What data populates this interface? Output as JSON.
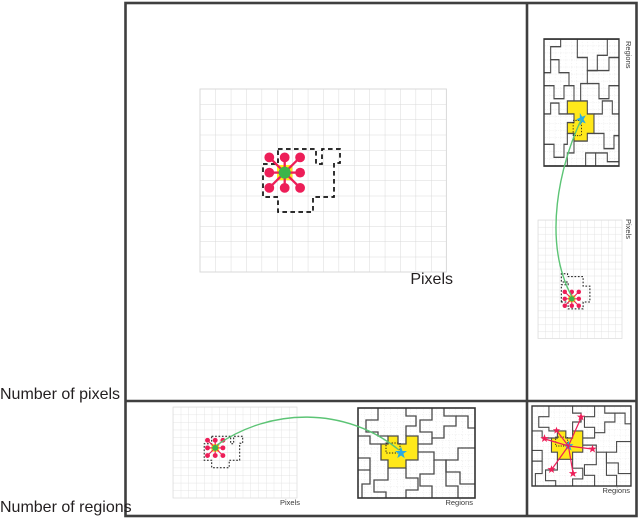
{
  "figure": {
    "row_labels": {
      "pixels": "Number of pixels",
      "regions": "Number of regions"
    },
    "panels": {
      "main_pixels": {
        "label": "Pixels"
      },
      "right_regions": {
        "label": "Regions"
      },
      "right_pixels": {
        "label": "Pixels"
      },
      "bottom_pixels": {
        "label": "Pixels"
      },
      "bottom_regions": {
        "label": "Regions"
      },
      "corner_regions": {
        "label": "Regions"
      }
    },
    "colors": {
      "highlight_yellow": "#FFE81A",
      "center_green": "#3CB54A",
      "neighbor_pink": "#ED1E58",
      "centroid_blue": "#29ABE2",
      "link_green": "#5CC475",
      "pixel_grid_gray": "#D9D9D9",
      "region_boundary_gray": "#4A4A4A",
      "frame_dark": "#3F3F3F"
    }
  }
}
